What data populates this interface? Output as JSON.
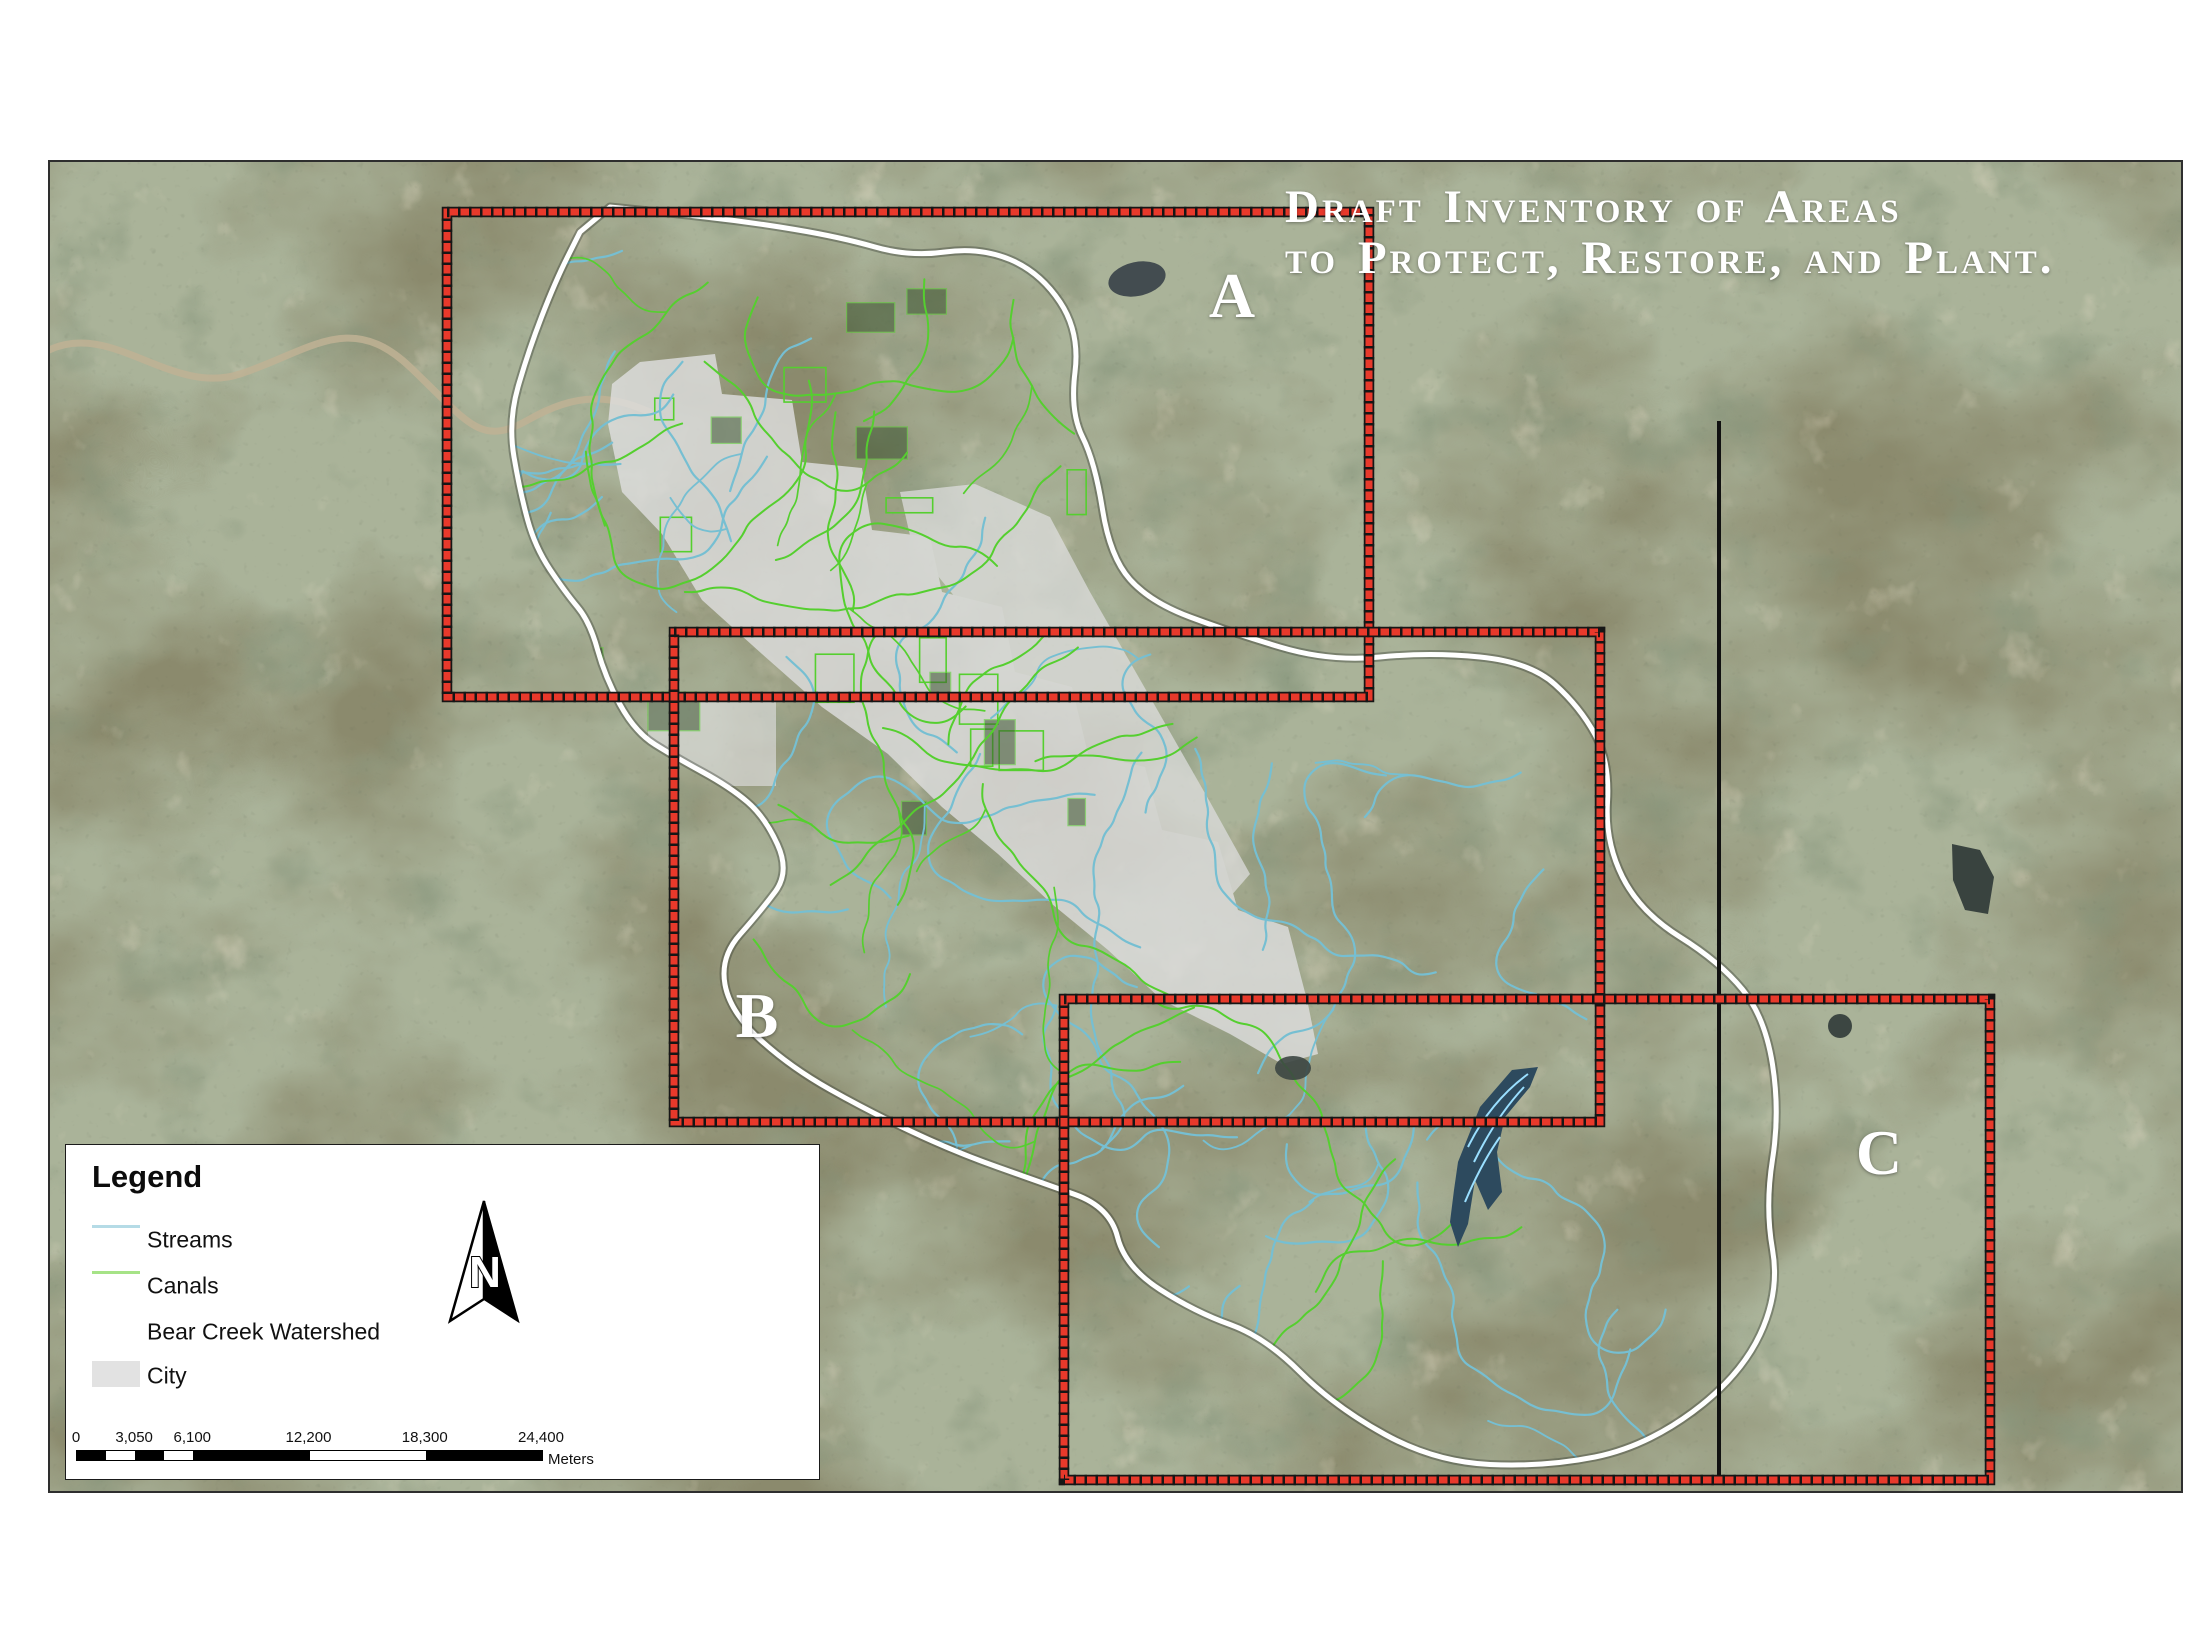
{
  "map": {
    "title": {
      "line1": "Draft Inventory of Areas",
      "line2": "to Protect, Restore, and Plant.",
      "color": "#ffffff"
    },
    "area_labels": [
      {
        "id": "A",
        "label": "A"
      },
      {
        "id": "B",
        "label": "B"
      },
      {
        "id": "C",
        "label": "C"
      }
    ],
    "colors": {
      "inventory_box_red": "#e8392b",
      "inventory_box_tick": "#161616",
      "watershed_outline": "#ffffff",
      "stream": "#76bfd2",
      "canal": "#55cf2f",
      "city_fill": "#dedede",
      "survey_line": "#111111",
      "reservoir_fill": "#2d4a5e",
      "reservoir_contour": "#9adfff"
    }
  },
  "legend": {
    "title": "Legend",
    "items": [
      {
        "label": "Streams",
        "swatch": "line",
        "color": "#b5dbe6"
      },
      {
        "label": "Canals",
        "swatch": "line",
        "color": "#a6e387"
      },
      {
        "label": "Bear Creek Watershed",
        "swatch": "line",
        "color": "#ffffff"
      },
      {
        "label": "City",
        "swatch": "fill",
        "color": "#e2e2e2"
      }
    ],
    "north_arrow": {
      "label": "N"
    },
    "scale_bar": {
      "tick_labels": [
        "0",
        "3,050",
        "6,100",
        "12,200",
        "18,300",
        "24,400"
      ],
      "tick_values_m": [
        0,
        3050,
        6100,
        12200,
        18300,
        24400
      ],
      "segment_breaks_m": [
        0,
        1525,
        3050,
        4575,
        6100,
        12200,
        18300,
        24400
      ],
      "max_m": 24400,
      "unit": "Meters"
    }
  }
}
